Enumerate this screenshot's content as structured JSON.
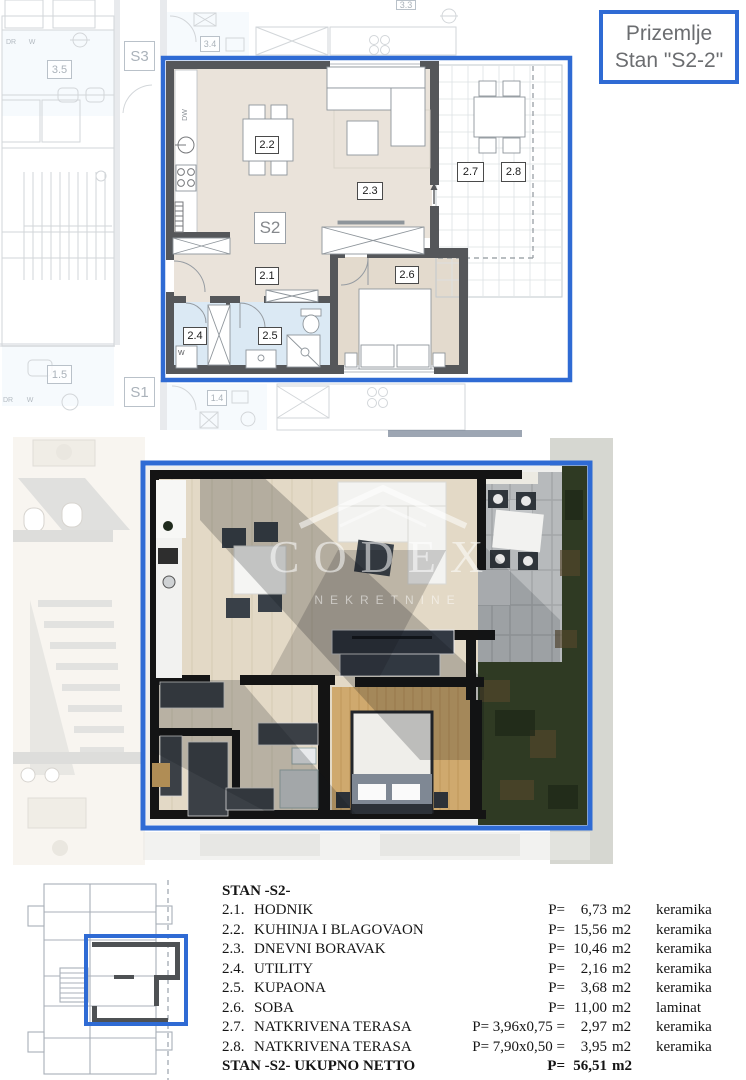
{
  "header": {
    "title_line1": "Prizemlje",
    "title_line2": "Stan \"S2-2\""
  },
  "colors": {
    "accent_blue": "#2f6bd4",
    "wall_gray": "#55575a",
    "floor_beige": "#eae3da",
    "wet_room_blue": "#dbe9f4",
    "bedroom_floor": "#e3dacd",
    "grass_green": "#2f3a23",
    "render_wood": "#cfa96e",
    "stone_terrace": "#b7babc"
  },
  "floorplan": {
    "unit": "S2",
    "labels": {
      "l21": "2.1",
      "l22": "2.2",
      "l23": "2.3",
      "l24": "2.4",
      "l25": "2.5",
      "l26": "2.6",
      "l27": "2.7",
      "l28": "2.8"
    },
    "fixtures": {
      "dishwasher": "DW",
      "washer": "W"
    },
    "context_labels": {
      "s3": "S3",
      "s1": "S1",
      "l33": "3.3",
      "l34": "3.4",
      "l35": "3.5",
      "l14": "1.4",
      "l15": "1.5",
      "dr_top": "DR",
      "w_top": "W",
      "dr_bottom": "DR",
      "w_bottom": "W"
    }
  },
  "render": {
    "watermark_line1": "CODEX",
    "watermark_line2": "NEKRETNINE"
  },
  "table": {
    "header": "STAN -S2-",
    "rows": [
      {
        "num": "2.1.",
        "name": "HODNIK",
        "pre": "P=",
        "value": "6,73",
        "unit": "m2",
        "material": "keramika"
      },
      {
        "num": "2.2.",
        "name": "KUHINJA I BLAGOVAONA",
        "pre": "P=",
        "value": "15,56",
        "unit": "m2",
        "material": "keramika"
      },
      {
        "num": "2.3.",
        "name": "DNEVNI BORAVAK",
        "pre": "P=",
        "value": "10,46",
        "unit": "m2",
        "material": "keramika"
      },
      {
        "num": "2.4.",
        "name": "UTILITY",
        "pre": "P=",
        "value": "2,16",
        "unit": "m2",
        "material": "keramika"
      },
      {
        "num": "2.5.",
        "name": "KUPAONA",
        "pre": "P=",
        "value": "3,68",
        "unit": "m2",
        "material": "keramika"
      },
      {
        "num": "2.6.",
        "name": "SOBA",
        "pre": "P=",
        "value": "11,00",
        "unit": "m2",
        "material": "laminat"
      },
      {
        "num": "2.7.",
        "name": "NATKRIVENA TERASA",
        "pre": "P= 3,96x0,75  =",
        "value": "2,97",
        "unit": "m2",
        "material": "keramika"
      },
      {
        "num": "2.8.",
        "name": "NATKRIVENA TERASA",
        "pre": "P= 7,90x0,50  =",
        "value": "3,95",
        "unit": "m2",
        "material": "keramika"
      }
    ],
    "footer": {
      "label": "STAN -S2- UKUPNO NETTO",
      "pre": "P=",
      "value": "56,51",
      "unit": "m2"
    }
  }
}
